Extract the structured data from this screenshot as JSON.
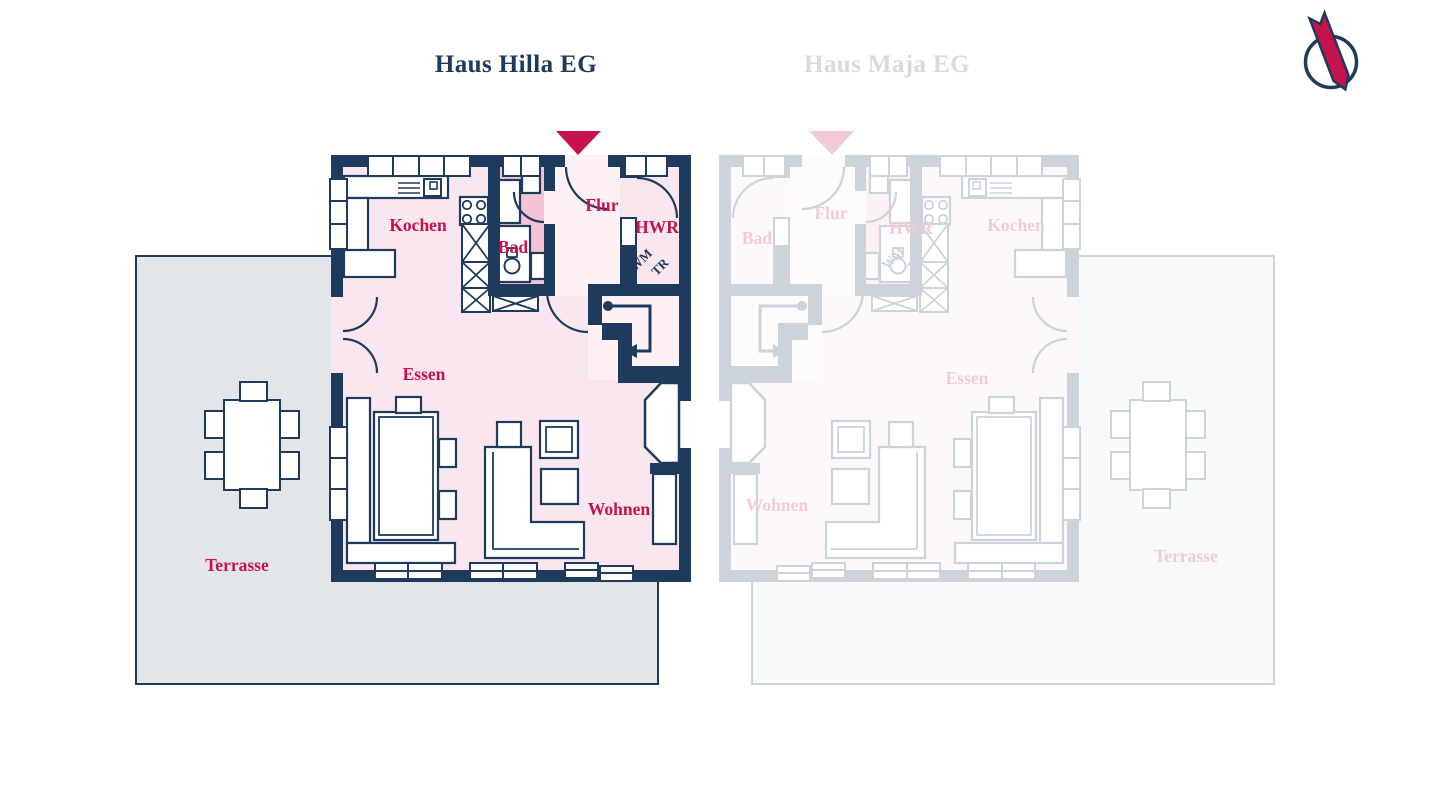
{
  "tabs": [
    {
      "label": "Haus Hilla EG",
      "active": true
    },
    {
      "label": "Haus Maja EG",
      "active": false
    }
  ],
  "logo": {
    "icon": "circle-ribbon-logo"
  },
  "colors": {
    "navy": "#1e3b5d",
    "crimson": "#c6134e",
    "room_pink": "#fae6ee",
    "hall_pink": "#fdf1f6",
    "bath_pink": "#f5c3d6",
    "terrace_gray": "#e3e6e8",
    "active_tab": "#1d3a5c",
    "inactive_tab": "#d6dbe0",
    "faded_plan_opacity": 0.22
  },
  "plans": {
    "hilla": {
      "title": "Haus Hilla EG",
      "faded": false,
      "entrance_marker": "triangle-down",
      "rooms": [
        {
          "id": "kochen",
          "label": "Kochen",
          "x": 418,
          "y": 231
        },
        {
          "id": "bad",
          "label": "Bad",
          "x": 513,
          "y": 253
        },
        {
          "id": "flur",
          "label": "Flur",
          "x": 602,
          "y": 211
        },
        {
          "id": "hwr",
          "label": "HWR",
          "x": 657,
          "y": 233
        },
        {
          "id": "essen",
          "label": "Essen",
          "x": 424,
          "y": 380
        },
        {
          "id": "wohnen",
          "label": "Wohnen",
          "x": 619,
          "y": 515
        },
        {
          "id": "terrasse",
          "label": "Terrasse",
          "x": 237,
          "y": 571
        }
      ],
      "appliances": [
        {
          "id": "wm",
          "label": "WM",
          "x": 644,
          "y": 263,
          "rotate": -45
        },
        {
          "id": "tr",
          "label": "TR",
          "x": 663,
          "y": 270,
          "rotate": -45
        }
      ]
    },
    "maja": {
      "title": "Haus Maja EG",
      "faded": true,
      "entrance_marker": "triangle-down",
      "rooms": [
        {
          "id": "bad",
          "label": "Bad",
          "x": 757,
          "y": 244
        },
        {
          "id": "flur",
          "label": "Flur",
          "x": 831,
          "y": 219
        },
        {
          "id": "hwr",
          "label": "HWR",
          "x": 911,
          "y": 234
        },
        {
          "id": "kochen",
          "label": "Kochen",
          "x": 1016,
          "y": 231
        },
        {
          "id": "essen",
          "label": "Essen",
          "x": 967,
          "y": 384
        },
        {
          "id": "wohnen",
          "label": "Wohnen",
          "x": 777,
          "y": 511
        },
        {
          "id": "terrasse",
          "label": "Terrasse",
          "x": 1186,
          "y": 562
        }
      ],
      "appliances": [
        {
          "id": "wm",
          "label": "WM",
          "x": 896,
          "y": 261,
          "rotate": -45
        },
        {
          "id": "tr",
          "label": "TR",
          "x": 918,
          "y": 266,
          "rotate": -45
        }
      ]
    }
  }
}
